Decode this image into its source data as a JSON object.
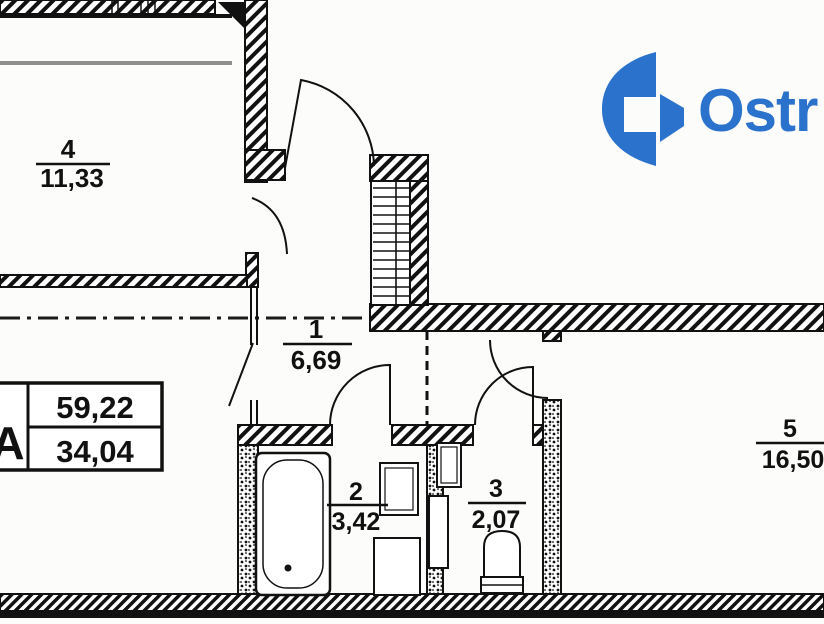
{
  "plan": {
    "rooms": [
      {
        "number": "4",
        "area": "11,33"
      },
      {
        "number": "1",
        "area": "6,69"
      },
      {
        "number": "2",
        "area": "3,42"
      },
      {
        "number": "3",
        "area": "2,07"
      },
      {
        "number": "5",
        "area": "16,50"
      }
    ],
    "info_table": {
      "series_letter": "А",
      "total_area": "59,22",
      "living_area": "34,04"
    }
  },
  "logo": {
    "brand_text": "Ostr"
  },
  "colors": {
    "ink": "#111111",
    "logo_blue": "#2b72cc",
    "background": "#fcfcfa",
    "balcony_gray": "#8f8f8f"
  }
}
